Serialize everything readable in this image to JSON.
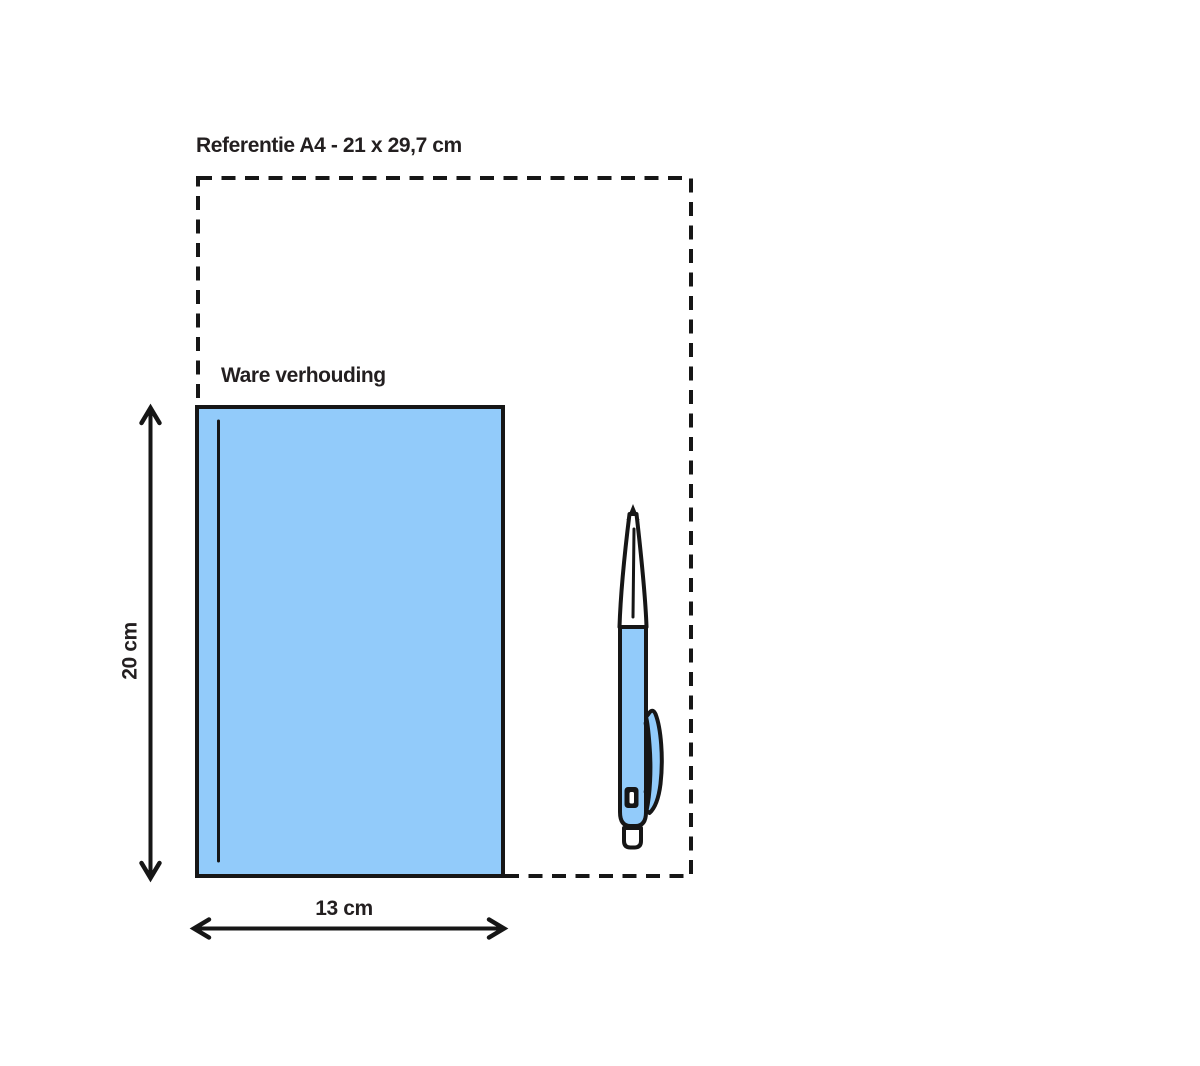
{
  "diagram": {
    "reference_label": "Referentie A4 - 21 x 29,7 cm",
    "true_scale_label": "Ware verhouding",
    "height_label": "20 cm",
    "width_label": "13 cm"
  },
  "dimensions": {
    "reference_format": "A4",
    "reference_size_cm": "21 x 29,7",
    "object_height_cm": "20",
    "object_width_cm": "13"
  },
  "colors": {
    "object_fill": "#92cbfa",
    "line": "#161616",
    "text": "#231f20",
    "background": "#ffffff"
  }
}
